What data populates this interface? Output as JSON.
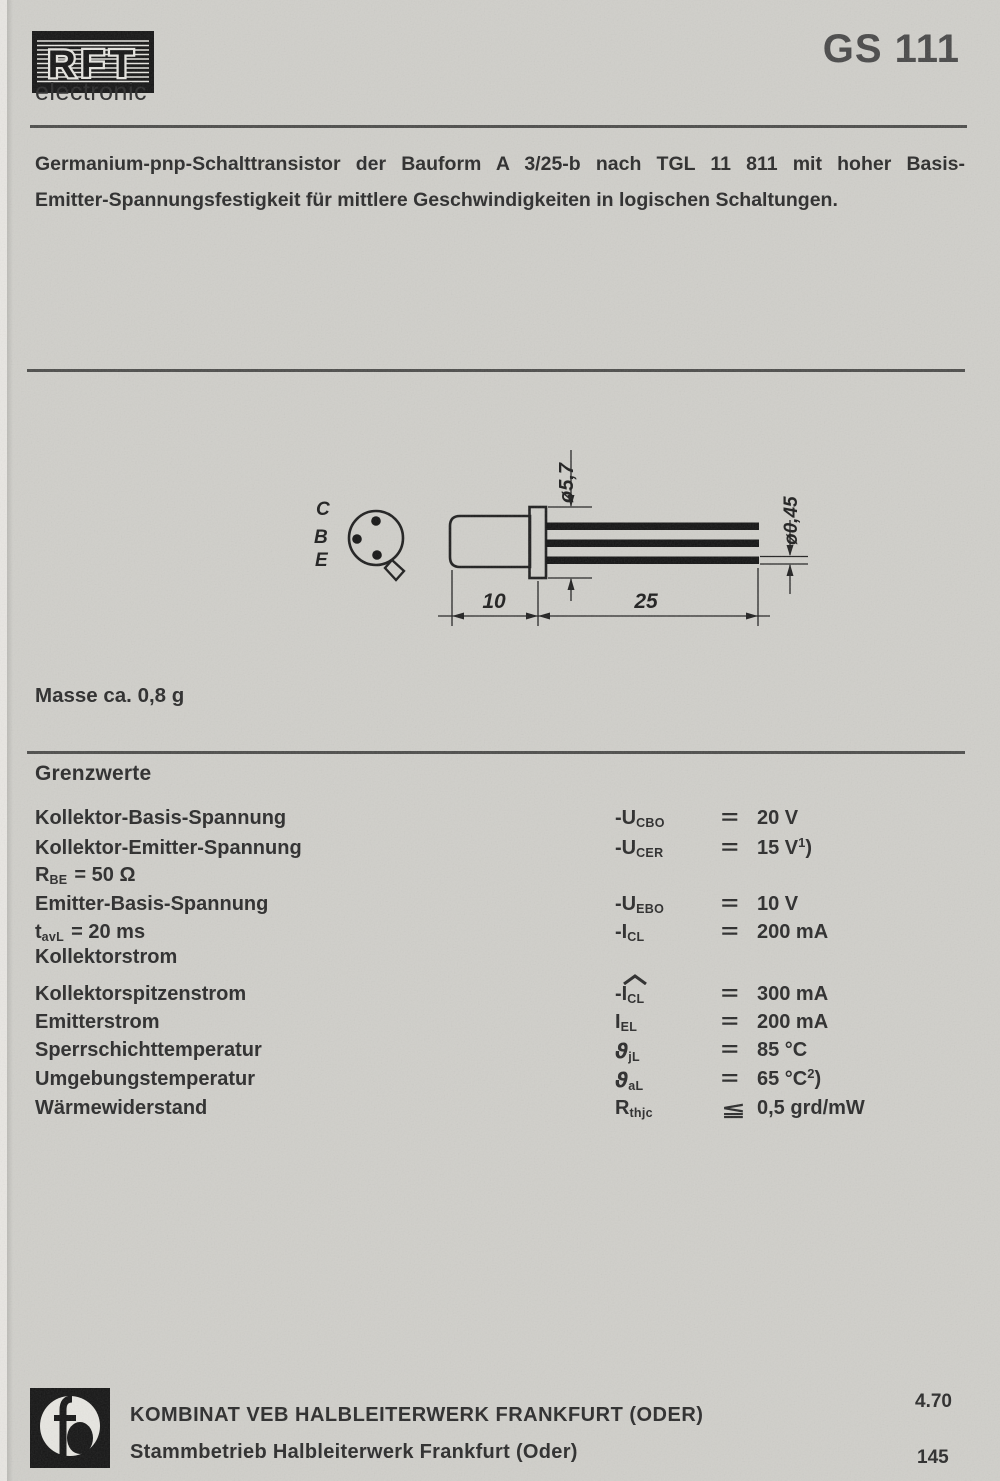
{
  "header": {
    "brand": "RFT",
    "brand_sub": "electronic",
    "part_number": "GS 111"
  },
  "description": {
    "line1": "Germanium-pnp-Schalttransistor der Bauform A 3/25-b nach TGL 11 811 mit hoher Basis-",
    "line2": "Emitter-Spannungsfestigkeit für mittlere Geschwindigkeiten in logischen Schaltungen."
  },
  "drawing": {
    "pinout": {
      "pins": [
        "C",
        "B",
        "E"
      ]
    },
    "dimensions": {
      "flange_diameter": "ø5,7",
      "lead_diameter": "ø0,45",
      "body_length": "10",
      "lead_length": "25"
    }
  },
  "mass_note": "Masse ca. 0,8 g",
  "limits": {
    "title": "Grenzwerte",
    "rows": [
      {
        "label": "Kollektor-Basis-Spannung",
        "sym_main": "-U",
        "sym_sub": "CBO",
        "rel": "=",
        "value": "20 V"
      },
      {
        "label": "Kollektor-Emitter-Spannung",
        "sym_main": "-U",
        "sym_sub": "CER",
        "rel": "=",
        "value": "15 V",
        "value_sup": "1",
        "value_after": ")"
      },
      {
        "label_main": "R",
        "label_sub": "BE",
        "label_rest": "= 50 Ω"
      },
      {
        "label": "Emitter-Basis-Spannung",
        "sym_main": "-U",
        "sym_sub": "EBO",
        "rel": "=",
        "value": "10 V"
      },
      {
        "label_main": "t",
        "label_sub": "avL",
        "label_rest": "= 20 ms",
        "sym_main": "-I",
        "sym_sub": "CL",
        "rel": "=",
        "value": "200 mA"
      },
      {
        "label": "Kollektorstrom"
      },
      {
        "label": "Kollektorspitzenstrom",
        "sym_main": "-I",
        "sym_sub": "CL",
        "has_hat": true,
        "rel": "=",
        "value": "300 mA"
      },
      {
        "label": "Emitterstrom",
        "sym_main": "I",
        "sym_sub": "EL",
        "rel": "=",
        "value": "200 mA"
      },
      {
        "label": "Sperrschichttemperatur",
        "sym_main": "ϑ",
        "sym_sub": "jL",
        "rel": "=",
        "value": "85 °C"
      },
      {
        "label": "Umgebungstemperatur",
        "sym_main": "ϑ",
        "sym_sub": "aL",
        "rel": "=",
        "value": "65 °C",
        "value_sup": "2",
        "value_after": ")"
      },
      {
        "label": "Wärmewiderstand",
        "sym_main": "R",
        "sym_sub": "thjc",
        "rel": "≦",
        "value": "0,5 grd/mW"
      }
    ]
  },
  "footer": {
    "line1": "KOMBINAT VEB HALBLEITERWERK FRANKFURT (ODER)",
    "line2": "Stammbetrieb Halbleiterwerk Frankfurt (Oder)",
    "date_code": "4.70",
    "page_number": "145"
  },
  "colors": {
    "paper": "#d0cfca",
    "ink": "#2c2c2c",
    "rule": "#4e4e4c",
    "lead_black": "#141414"
  }
}
